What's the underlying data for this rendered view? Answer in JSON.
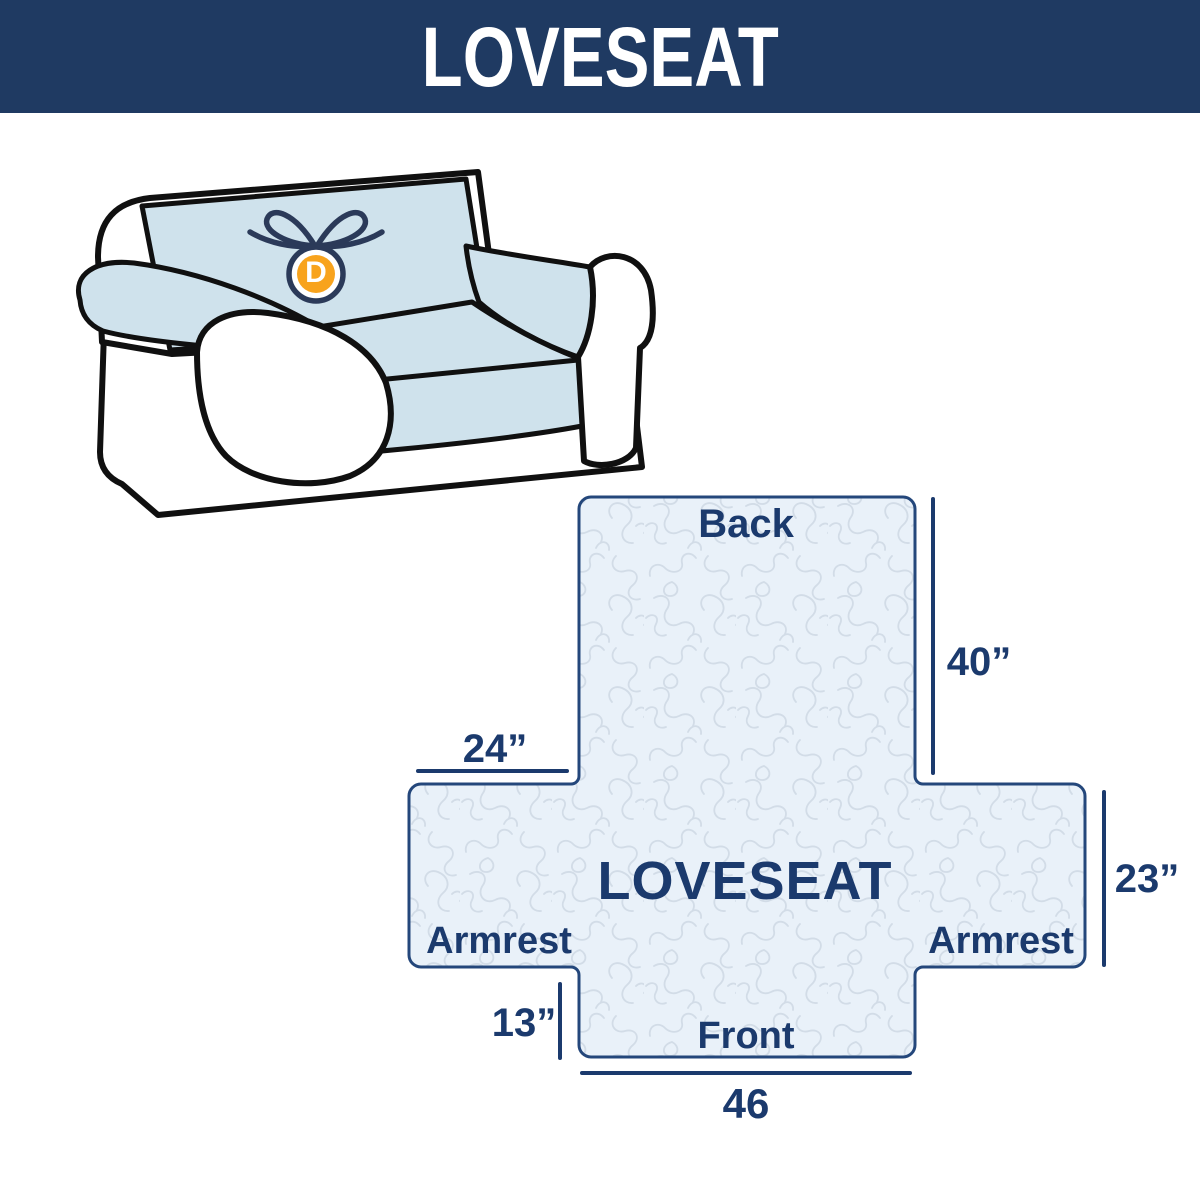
{
  "header": {
    "title": "LOVESEAT"
  },
  "couch": {
    "logo_letter": "D"
  },
  "diagram": {
    "back_label": "Back",
    "front_label": "Front",
    "armrest_left_label": "Armrest",
    "armrest_right_label": "Armrest",
    "center_label": "LOVESEAT",
    "dimensions": {
      "back_height": "40”",
      "armrest_top_width": "24”",
      "armrest_side_height": "23”",
      "front_skirt_height": "13”",
      "front_width": "46"
    }
  },
  "colors": {
    "header_bg": "#1f3a62",
    "navy_text": "#1b3a6d",
    "diagram_border": "#24477b",
    "diagram_fill": "#e9f1f9",
    "quilt_pattern_stroke": "#d2dce7",
    "cover_blue": "#cfe2ec",
    "outline_black": "#101010",
    "logo_orange": "#f8a31d",
    "logo_navy": "#2b3a59"
  }
}
